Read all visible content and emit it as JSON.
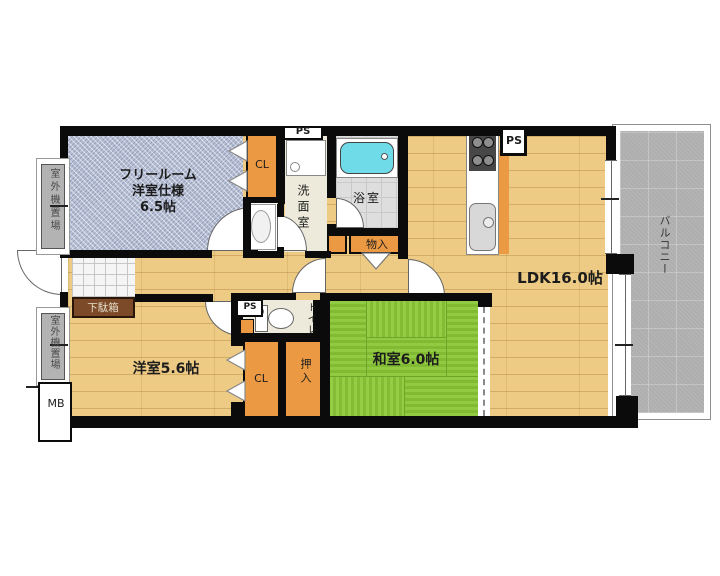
{
  "plan": {
    "rooms": {
      "free_room": {
        "line1": "フリールーム",
        "line2": "洋室仕様",
        "line3": "6.5帖"
      },
      "ldk": {
        "label": "LDK16.0帖"
      },
      "washitsu": {
        "label": "和室6.0帖"
      },
      "yoshitsu": {
        "label": "洋室5.6帖"
      },
      "senmen": {
        "label": "洗面室"
      },
      "bath": {
        "label": "浴室"
      },
      "toilet": {
        "label": "トイレ"
      },
      "balcony": {
        "label": "バルコニー"
      }
    },
    "storage": {
      "cl_upper": "CL",
      "cl_lower": "CL",
      "oshiire": "押入",
      "monoire": "物入",
      "getabako": "下駄箱"
    },
    "service": {
      "ps_top": "PS",
      "ps_kitchen": "PS",
      "ps_toilet": "PS",
      "mb": "MB",
      "outdoor_unit_upper": "室外機置場",
      "outdoor_unit_lower": "室外機置場"
    },
    "colors": {
      "wall": "#0b0b0b",
      "wood_floor": "#edcb84",
      "tatami_green": "#8cc63e",
      "closet_orange": "#eb9a43",
      "free_room_blue": "#b9c1d6",
      "balcony_gray": "#aeaeae",
      "bathtub_cyan": "#6fdbe8",
      "shoe_cabinet_brown": "#7c4a28"
    }
  }
}
